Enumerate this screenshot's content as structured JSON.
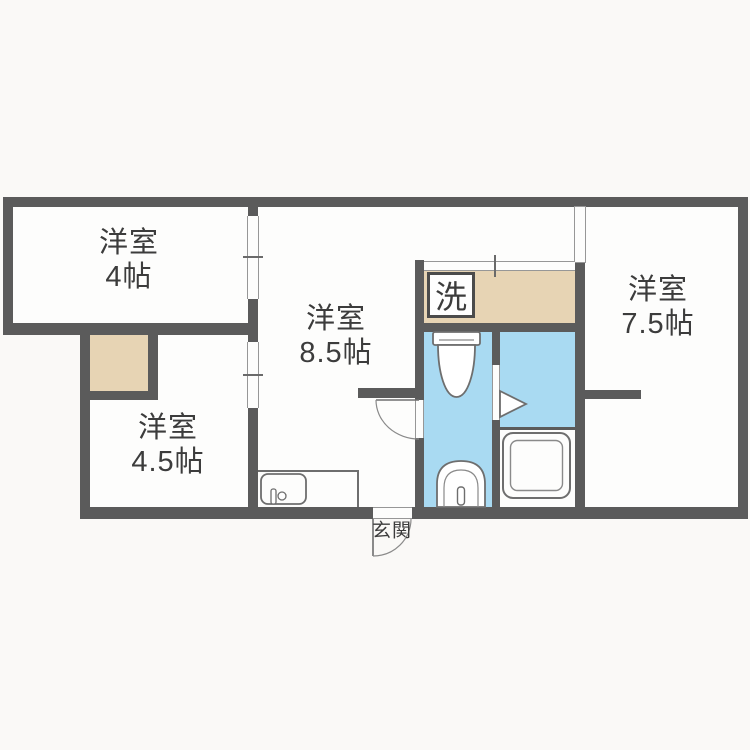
{
  "plan": {
    "title": "apartment floor plan",
    "rooms": [
      {
        "name": "洋室",
        "size": "4帖"
      },
      {
        "name": "洋室",
        "size": "8.5帖"
      },
      {
        "name": "洋室",
        "size": "7.5帖"
      },
      {
        "name": "洋室",
        "size": "4.5帖"
      }
    ],
    "labels": {
      "laundry": "洗",
      "entrance": "玄関"
    },
    "colors": {
      "wall": "#5b5b5b",
      "tatami_beige": "#e7d4b4",
      "wet_area_blue": "#a9daf2",
      "floor": "#fdfdfc",
      "background": "#faf9f7",
      "text": "#3c3c3c"
    }
  }
}
